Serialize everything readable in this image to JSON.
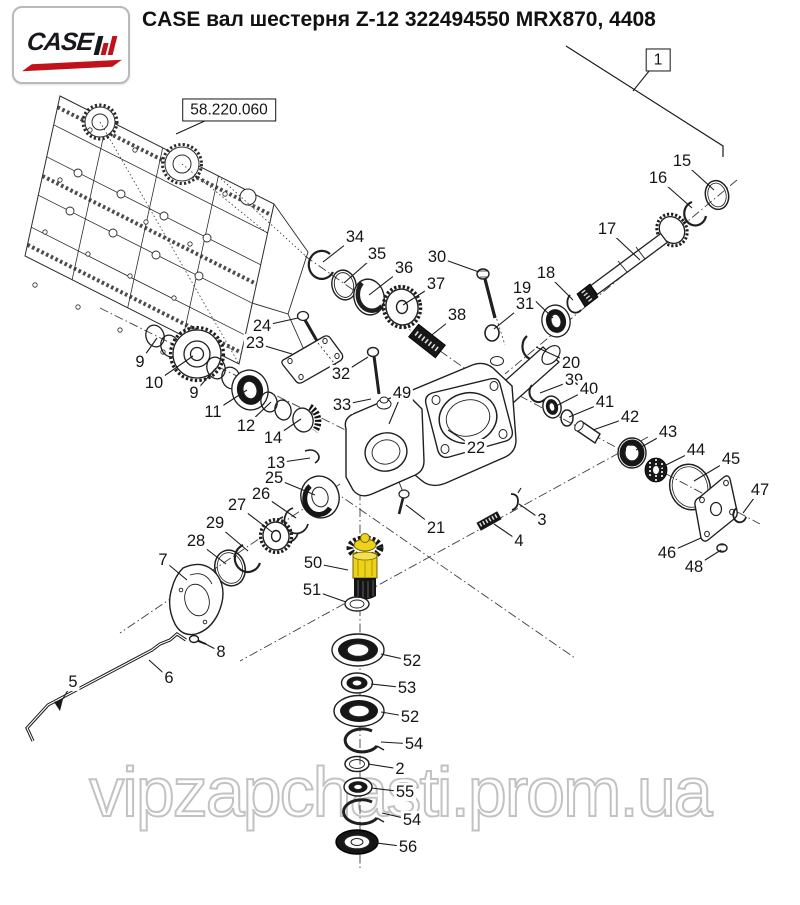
{
  "page": {
    "width": 800,
    "height": 905,
    "background": "#ffffff"
  },
  "header": {
    "title": "CASE вал шестерня Z-12 322494550 MRX870, 4408",
    "logo": {
      "brand": "CASE",
      "mark": "IH",
      "text_color": "#17171c",
      "accent_color": "#c1121c",
      "border_color": "#b9b9b9"
    }
  },
  "watermark": {
    "text": "vipzapchasti.prom.ua",
    "outline_color": "#c2c2c2"
  },
  "diagram": {
    "highlighted_part": {
      "callout": "50",
      "color": "#edd21c"
    },
    "callouts": [
      {
        "label": "1",
        "x": 658,
        "y": 60,
        "tx": 633,
        "ty": 91,
        "boxed": true
      },
      {
        "label": "58.220.060",
        "x": 229,
        "y": 110,
        "tx": 176,
        "ty": 134,
        "boxed": true
      },
      {
        "label": "15",
        "x": 682,
        "y": 161,
        "tx": 714,
        "ty": 190
      },
      {
        "label": "16",
        "x": 658,
        "y": 178,
        "tx": 692,
        "ty": 208
      },
      {
        "label": "17",
        "x": 607,
        "y": 229,
        "tx": 640,
        "ty": 260
      },
      {
        "label": "34",
        "x": 355,
        "y": 237,
        "tx": 323,
        "ty": 262
      },
      {
        "label": "35",
        "x": 377,
        "y": 254,
        "tx": 344,
        "ty": 283
      },
      {
        "label": "36",
        "x": 404,
        "y": 268,
        "tx": 369,
        "ty": 295
      },
      {
        "label": "30",
        "x": 437,
        "y": 257,
        "tx": 479,
        "ty": 272
      },
      {
        "label": "37",
        "x": 436,
        "y": 284,
        "tx": 403,
        "ty": 305
      },
      {
        "label": "38",
        "x": 457,
        "y": 315,
        "tx": 428,
        "ty": 338
      },
      {
        "label": "18",
        "x": 546,
        "y": 273,
        "tx": 573,
        "ty": 300
      },
      {
        "label": "19",
        "x": 522,
        "y": 288,
        "tx": 553,
        "ty": 318
      },
      {
        "label": "31",
        "x": 525,
        "y": 304,
        "tx": 494,
        "ty": 329
      },
      {
        "label": "20",
        "x": 571,
        "y": 363,
        "tx": 536,
        "ty": 347
      },
      {
        "label": "24",
        "x": 262,
        "y": 326,
        "tx": 298,
        "ty": 318
      },
      {
        "label": "23",
        "x": 255,
        "y": 343,
        "tx": 292,
        "ty": 354
      },
      {
        "label": "9",
        "x": 140,
        "y": 362,
        "tx": 157,
        "ty": 338
      },
      {
        "label": "10",
        "x": 154,
        "y": 383,
        "tx": 193,
        "ty": 356
      },
      {
        "label": "9",
        "x": 194,
        "y": 393,
        "tx": 216,
        "ty": 368
      },
      {
        "label": "11",
        "x": 213,
        "y": 412,
        "tx": 247,
        "ty": 390
      },
      {
        "label": "12",
        "x": 246,
        "y": 426,
        "tx": 271,
        "ty": 402
      },
      {
        "label": "14",
        "x": 273,
        "y": 438,
        "tx": 301,
        "ty": 419
      },
      {
        "label": "32",
        "x": 341,
        "y": 374,
        "tx": 368,
        "ty": 357
      },
      {
        "label": "33",
        "x": 342,
        "y": 405,
        "tx": 371,
        "ty": 399
      },
      {
        "label": "49",
        "x": 402,
        "y": 393,
        "tx": 389,
        "ty": 424
      },
      {
        "label": "22",
        "x": 476,
        "y": 448,
        "tx": 448,
        "ty": 430
      },
      {
        "label": "39",
        "x": 574,
        "y": 380,
        "tx": 540,
        "ty": 393
      },
      {
        "label": "40",
        "x": 589,
        "y": 389,
        "tx": 554,
        "ty": 407
      },
      {
        "label": "41",
        "x": 605,
        "y": 402,
        "tx": 569,
        "ty": 417
      },
      {
        "label": "42",
        "x": 630,
        "y": 417,
        "tx": 593,
        "ty": 430
      },
      {
        "label": "43",
        "x": 668,
        "y": 432,
        "tx": 636,
        "ty": 450
      },
      {
        "label": "44",
        "x": 696,
        "y": 450,
        "tx": 660,
        "ty": 468
      },
      {
        "label": "45",
        "x": 731,
        "y": 459,
        "tx": 694,
        "ty": 481
      },
      {
        "label": "47",
        "x": 760,
        "y": 490,
        "tx": 743,
        "ty": 513
      },
      {
        "label": "46",
        "x": 667,
        "y": 553,
        "tx": 701,
        "ty": 538
      },
      {
        "label": "48",
        "x": 694,
        "y": 567,
        "tx": 721,
        "ty": 550
      },
      {
        "label": "13",
        "x": 276,
        "y": 463,
        "tx": 310,
        "ty": 458
      },
      {
        "label": "25",
        "x": 274,
        "y": 478,
        "tx": 315,
        "ty": 495
      },
      {
        "label": "26",
        "x": 261,
        "y": 494,
        "tx": 296,
        "ty": 518
      },
      {
        "label": "27",
        "x": 237,
        "y": 505,
        "tx": 272,
        "ty": 532
      },
      {
        "label": "29",
        "x": 215,
        "y": 523,
        "tx": 248,
        "ty": 551
      },
      {
        "label": "28",
        "x": 196,
        "y": 541,
        "tx": 226,
        "ty": 564
      },
      {
        "label": "7",
        "x": 163,
        "y": 560,
        "tx": 187,
        "ty": 580
      },
      {
        "label": "50",
        "x": 313,
        "y": 563,
        "tx": 348,
        "ty": 570
      },
      {
        "label": "51",
        "x": 312,
        "y": 590,
        "tx": 346,
        "ty": 602
      },
      {
        "label": "21",
        "x": 436,
        "y": 528,
        "tx": 406,
        "ty": 505
      },
      {
        "label": "3",
        "x": 542,
        "y": 520,
        "tx": 519,
        "ty": 504
      },
      {
        "label": "4",
        "x": 519,
        "y": 541,
        "tx": 494,
        "ty": 524
      },
      {
        "label": "8",
        "x": 221,
        "y": 652,
        "tx": 198,
        "ty": 640
      },
      {
        "label": "5",
        "x": 73,
        "y": 682,
        "tx": 59,
        "ty": 705
      },
      {
        "label": "6",
        "x": 169,
        "y": 678,
        "tx": 149,
        "ty": 660
      },
      {
        "label": "52",
        "x": 412,
        "y": 661,
        "tx": 381,
        "ty": 654
      },
      {
        "label": "53",
        "x": 407,
        "y": 688,
        "tx": 371,
        "ty": 684
      },
      {
        "label": "52",
        "x": 410,
        "y": 717,
        "tx": 381,
        "ty": 712
      },
      {
        "label": "54",
        "x": 414,
        "y": 744,
        "tx": 381,
        "ty": 742
      },
      {
        "label": "2",
        "x": 400,
        "y": 769,
        "tx": 368,
        "ty": 764
      },
      {
        "label": "55",
        "x": 405,
        "y": 792,
        "tx": 371,
        "ty": 788
      },
      {
        "label": "54",
        "x": 412,
        "y": 820,
        "tx": 382,
        "ty": 813
      },
      {
        "label": "56",
        "x": 408,
        "y": 847,
        "tx": 377,
        "ty": 843
      }
    ]
  }
}
